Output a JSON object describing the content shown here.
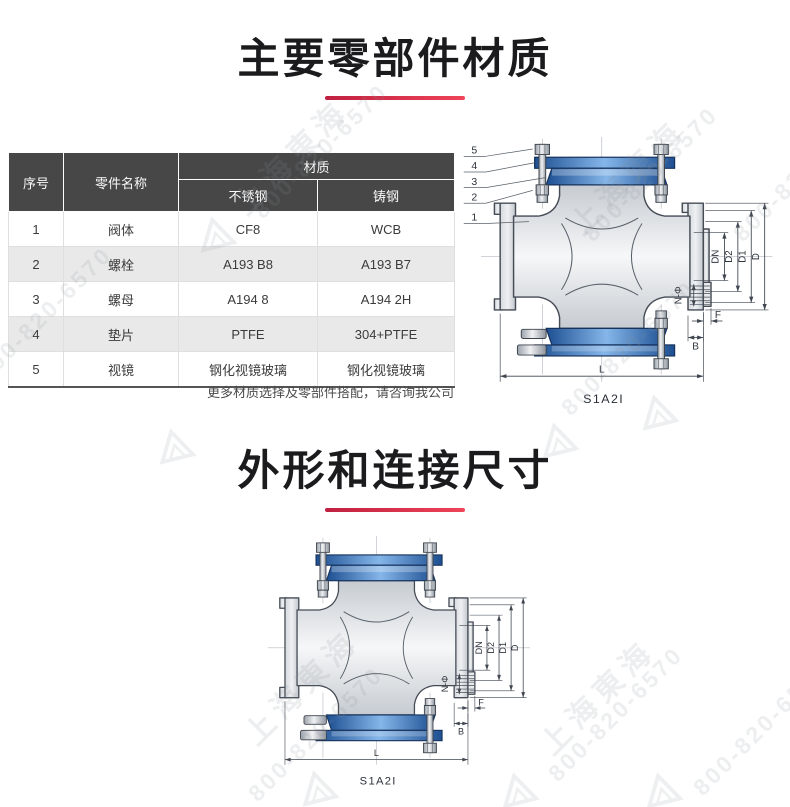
{
  "section1": {
    "title": "主要零部件材质"
  },
  "table": {
    "header": {
      "col_no": "序号",
      "col_part": "零件名称",
      "col_material": "材质",
      "col_ss": "不锈钢",
      "col_cs": "铸钢"
    },
    "rows": [
      {
        "no": "1",
        "part": "阀体",
        "ss": "CF8",
        "cs": "WCB"
      },
      {
        "no": "2",
        "part": "螺栓",
        "ss": "A193 B8",
        "cs": "A193 B7"
      },
      {
        "no": "3",
        "part": "螺母",
        "ss": "A194 8",
        "cs": "A194 2H"
      },
      {
        "no": "4",
        "part": "垫片",
        "ss": "PTFE",
        "cs": "304+PTFE"
      },
      {
        "no": "5",
        "part": "视镜",
        "ss": "钢化视镜玻璃",
        "cs": "钢化视镜玻璃"
      }
    ],
    "note": "更多材质选择及零部件搭配，请咨询我公司"
  },
  "section2": {
    "title": "外形和连接尺寸"
  },
  "drawing": {
    "model": "S1A2I",
    "callouts": [
      "1",
      "2",
      "3",
      "4",
      "5"
    ],
    "dims": {
      "dn": "DN",
      "d2": "D2",
      "d1": "D1",
      "d": "D",
      "nphi": "N-Φ",
      "f": "F",
      "b": "B",
      "l": "L"
    }
  },
  "watermark": {
    "brand": "上海東海",
    "phone": "800-820-6570"
  },
  "colors": {
    "accent_red": "#d93a4d",
    "header_bg": "#474747",
    "row_alt": "#e9e9e9",
    "ring_blue": "#2f6db6",
    "ring_edge": "#17335c",
    "line": "#454c56",
    "body_gray": "#dfe3e7"
  }
}
